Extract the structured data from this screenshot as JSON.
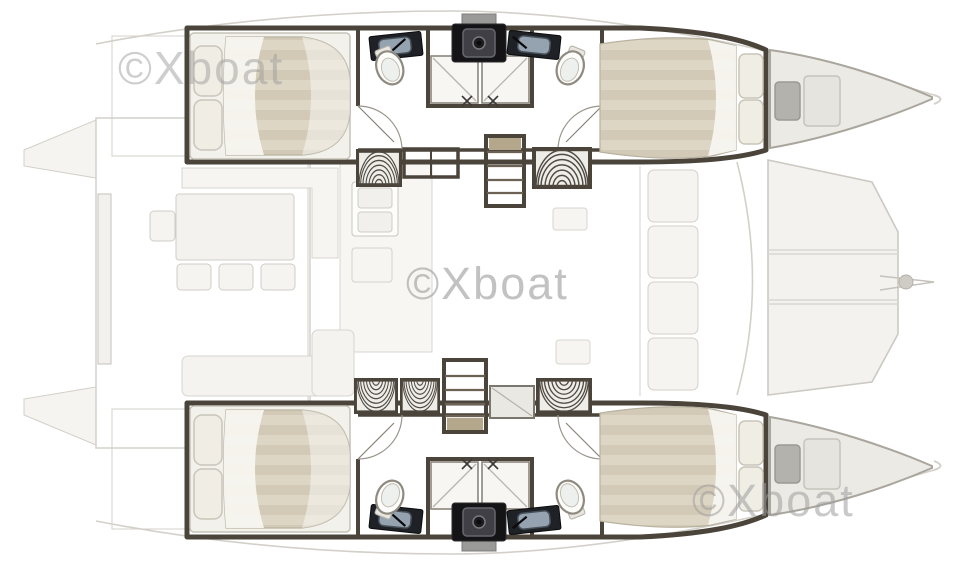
{
  "watermarks": {
    "top_left": "©Xboat",
    "center": "©Xboat",
    "bottom_right": "©Xboat"
  },
  "colors": {
    "wood": "#c8baa1",
    "wall": "#4a443b",
    "wm": "#9e9e9e",
    "mattress-light": "#ded6c4",
    "mattress-dark": "#d2cab6",
    "fixture-dark": "#1e2126",
    "shower-white": "#f7f6f3",
    "berth-beige": "#eceae4"
  }
}
